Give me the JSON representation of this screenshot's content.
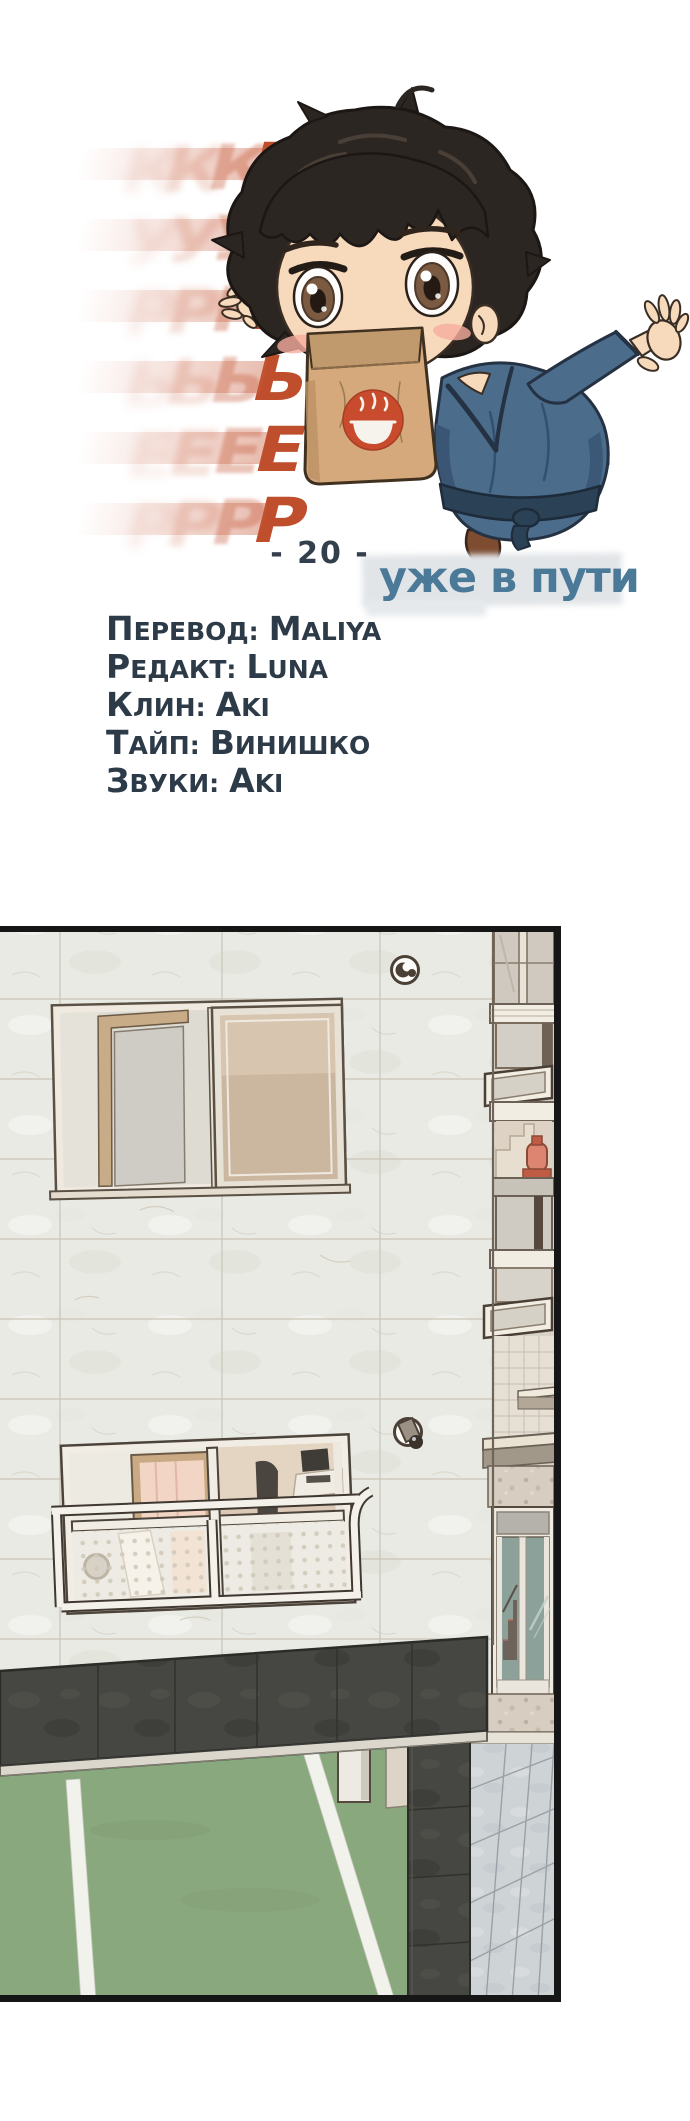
{
  "header": {
    "title": {
      "text": "КУРЬЕР",
      "letters": [
        "К",
        "У",
        "Р",
        "Ь",
        "Е",
        "Р"
      ]
    },
    "chapter_label": "- 20 -",
    "subtitle": "уже в пути",
    "credits": [
      {
        "role": "Перевод:",
        "name": "Maliya"
      },
      {
        "role": "Редакт:",
        "name": "Luna"
      },
      {
        "role": "Клин:",
        "name": "Aki"
      },
      {
        "role": "Тайп:",
        "name": "Винишко"
      },
      {
        "role": "Звуки:",
        "name": "Aki"
      }
    ]
  },
  "icons": {
    "bag_logo": "ramen-bowl-icon"
  },
  "colors": {
    "title_red": "#bf4e2c",
    "credits_navy": "#2d3a48",
    "subtitle_blue": "#4b7a99",
    "panel_wall": "#e9eae4",
    "canopy_dark": "#474743",
    "court_green": "#8aa87e",
    "entrance_glass_teal": "#8ba19a",
    "bag_logo_red": "#c94b2d",
    "extinguisher_red": "#dd8570"
  }
}
